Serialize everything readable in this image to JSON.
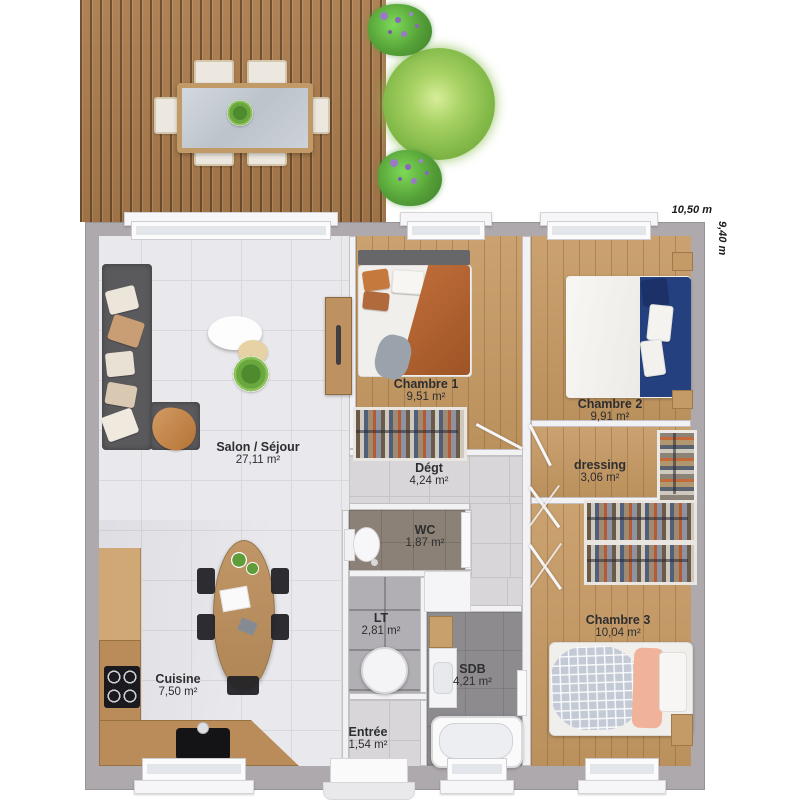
{
  "plan": {
    "dimensions": {
      "width_label": "10,50 m",
      "height_label": "9,40 m"
    },
    "rooms": [
      {
        "name": "Salon / Séjour",
        "area": "27,11 m²"
      },
      {
        "name": "Chambre 1",
        "area": "9,51 m²"
      },
      {
        "name": "Dégt",
        "area": "4,24 m²"
      },
      {
        "name": "Chambre 2",
        "area": "9,91 m²"
      },
      {
        "name": "dressing",
        "area": "3,06 m²"
      },
      {
        "name": "WC",
        "area": "1,87 m²"
      },
      {
        "name": "LT",
        "area": "2,81 m²"
      },
      {
        "name": "SDB",
        "area": "4,21 m²"
      },
      {
        "name": "Chambre 3",
        "area": "10,04 m²"
      },
      {
        "name": "Cuisine",
        "area": "7,50 m²"
      },
      {
        "name": "Entrée",
        "area": "1,54 m²"
      }
    ],
    "colors": {
      "exterior_wall": "#ada9ad",
      "wood_floor": "#c69a63",
      "deck_wood": "#ab7c4c",
      "white_tile": "#e9e8ec",
      "sdb_floor": "#8d8b8e",
      "wc_floor": "#8c8176",
      "sofa_gray": "#5a595c",
      "accent_orange": "#ad5f2c",
      "accent_navy": "#24407e",
      "accent_peach": "#f1b29a",
      "plant_green": "#86bc4b",
      "label_text": "#2e2e30"
    }
  }
}
